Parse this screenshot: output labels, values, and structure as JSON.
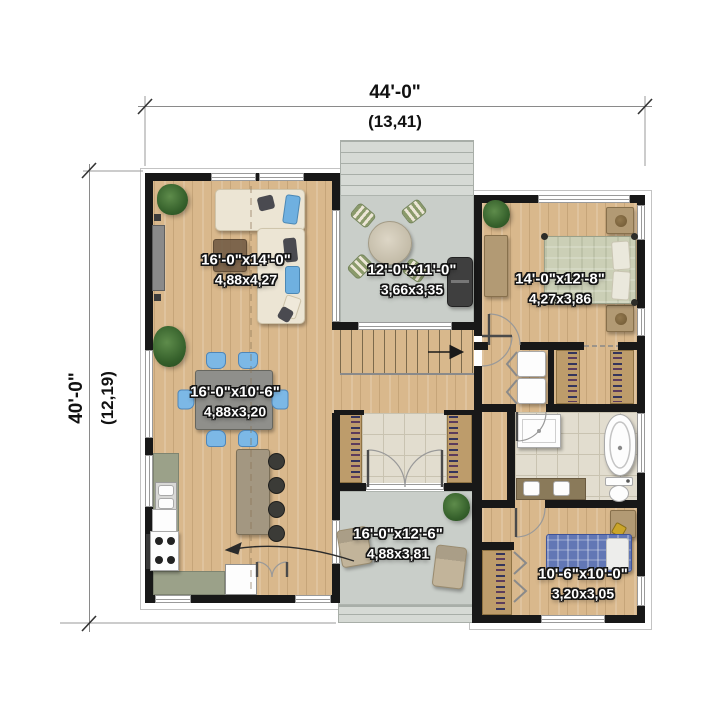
{
  "plan": {
    "overall_width": {
      "imperial": "44'-0\"",
      "metric": "(13,41)"
    },
    "overall_depth": {
      "imperial": "40'-0\"",
      "metric": "(12,19)"
    },
    "rooms": [
      {
        "id": "living-room",
        "imperial": "16'-0\"x14'-0\"",
        "metric": "4,88x4,27"
      },
      {
        "id": "rear-deck",
        "imperial": "12'-0\"x11'-0\"",
        "metric": "3,66x3,35"
      },
      {
        "id": "master-bedroom",
        "imperial": "14'-0\"x12'-8\"",
        "metric": "4,27x3,86"
      },
      {
        "id": "dining-area",
        "imperial": "16'-0\"x10'-6\"",
        "metric": "4,88x3,20"
      },
      {
        "id": "front-patio",
        "imperial": "16'-0\"x12'-6\"",
        "metric": "4,88x3,81"
      },
      {
        "id": "bedroom-2",
        "imperial": "10'-6\"x10'-0\"",
        "metric": "3,20x3,05"
      }
    ],
    "colors": {
      "wall": "#181818",
      "wood_floor": "#d9b88c",
      "concrete": "#c9cec9",
      "tile": "#e2ddcf",
      "counter": "#9ba189",
      "accent_chair_blue": "#7cb8e6",
      "bed_green": "#cbcfb6",
      "bed_blue_plaid": "#6277b5",
      "plant_green": "#3f6b33",
      "label_text": "#ffffff",
      "dimension_text": "#111111"
    }
  }
}
